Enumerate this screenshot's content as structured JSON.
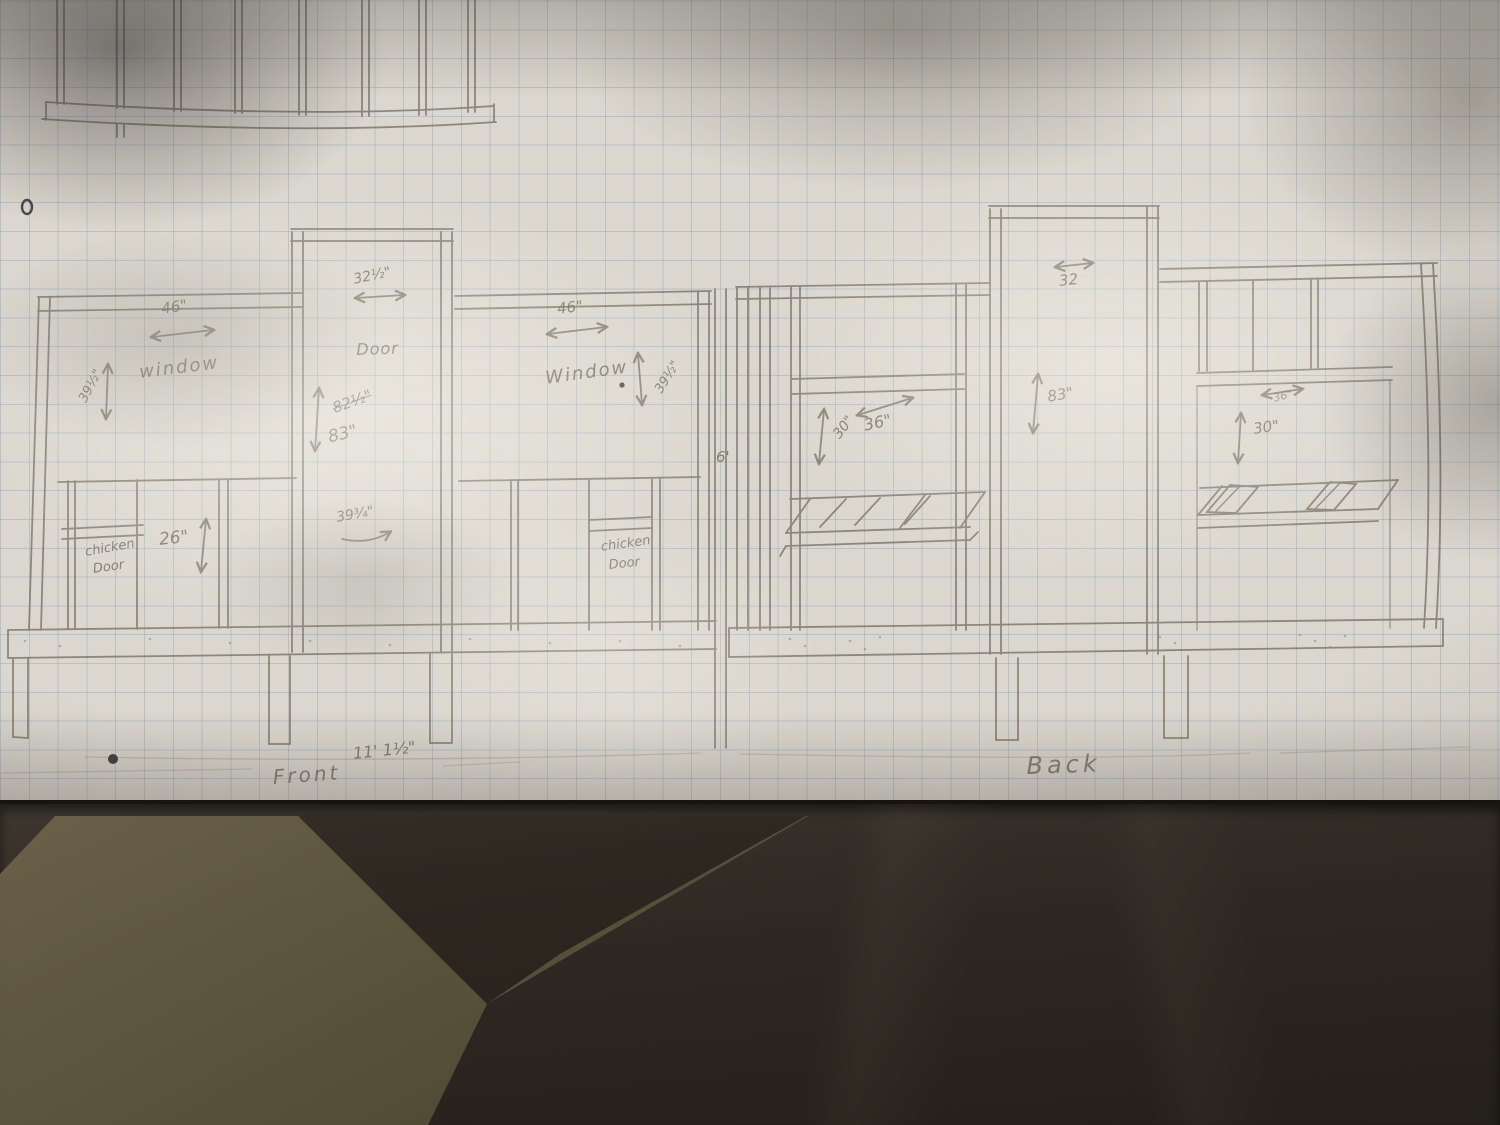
{
  "sheet": {
    "description": "pencil construction sketch of a chicken coop on graph paper",
    "front_view": {
      "label": "Front",
      "overall_length": "11' 1½\"",
      "window_left": {
        "label": "window",
        "width": "46\"",
        "height": "39½\""
      },
      "door": {
        "label": "Door",
        "width": "32½\"",
        "height_crossed_out": "82½\"",
        "height": "83\"",
        "lower_note": "39¾\""
      },
      "window_right": {
        "label": "Window",
        "width": "46\"",
        "height": "39½\""
      },
      "chicken_door_left": {
        "line1": "chicken",
        "line2": "Door",
        "height": "26\""
      },
      "chicken_door_right": {
        "line1": "chicken",
        "line2": "Door"
      },
      "floor_height": "6'"
    },
    "back_view": {
      "label": "Back",
      "opening_left": {
        "width": "36\"",
        "height": "30\""
      },
      "door": {
        "width": "32",
        "height": "83\""
      },
      "opening_right": {
        "width": "36\"",
        "height": "30\""
      }
    },
    "colors": {
      "paper": "#dcd7ce",
      "grid": "#8fb3cc",
      "pencil": "#7b7569",
      "table_dark": "#2c2621",
      "table_khaki": "#665c46"
    }
  }
}
